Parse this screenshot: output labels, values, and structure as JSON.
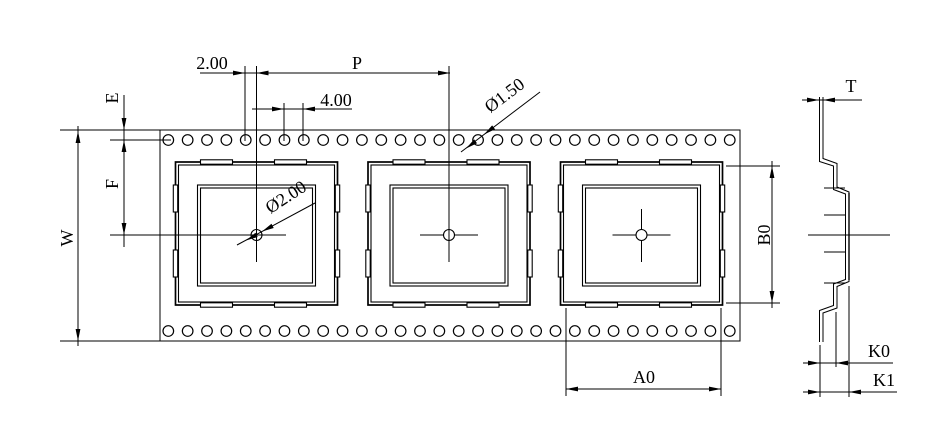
{
  "drawing": {
    "kind": "carrier-tape-dimension-drawing",
    "line_color": "#000000",
    "background": "#ffffff"
  },
  "labels": {
    "top": {
      "hole_to_pocket_offset": "2.00",
      "pocket_pitch": "P",
      "sprocket_hole_pitch": "4.00",
      "sprocket_hole_dia": "Ø1.50"
    },
    "left": {
      "edge_margin": "E",
      "hole_to_center": "F",
      "tape_width": "W"
    },
    "pocket": {
      "center_hole_dia": "Ø2.00",
      "pocket_length": "B0",
      "pocket_width": "A0"
    },
    "side": {
      "tape_thickness": "T",
      "pocket_depth": "K0",
      "total_depth": "K1"
    }
  },
  "tape": {
    "hole_rows": 2,
    "holes_per_row": 30,
    "pockets_visible": 3
  }
}
